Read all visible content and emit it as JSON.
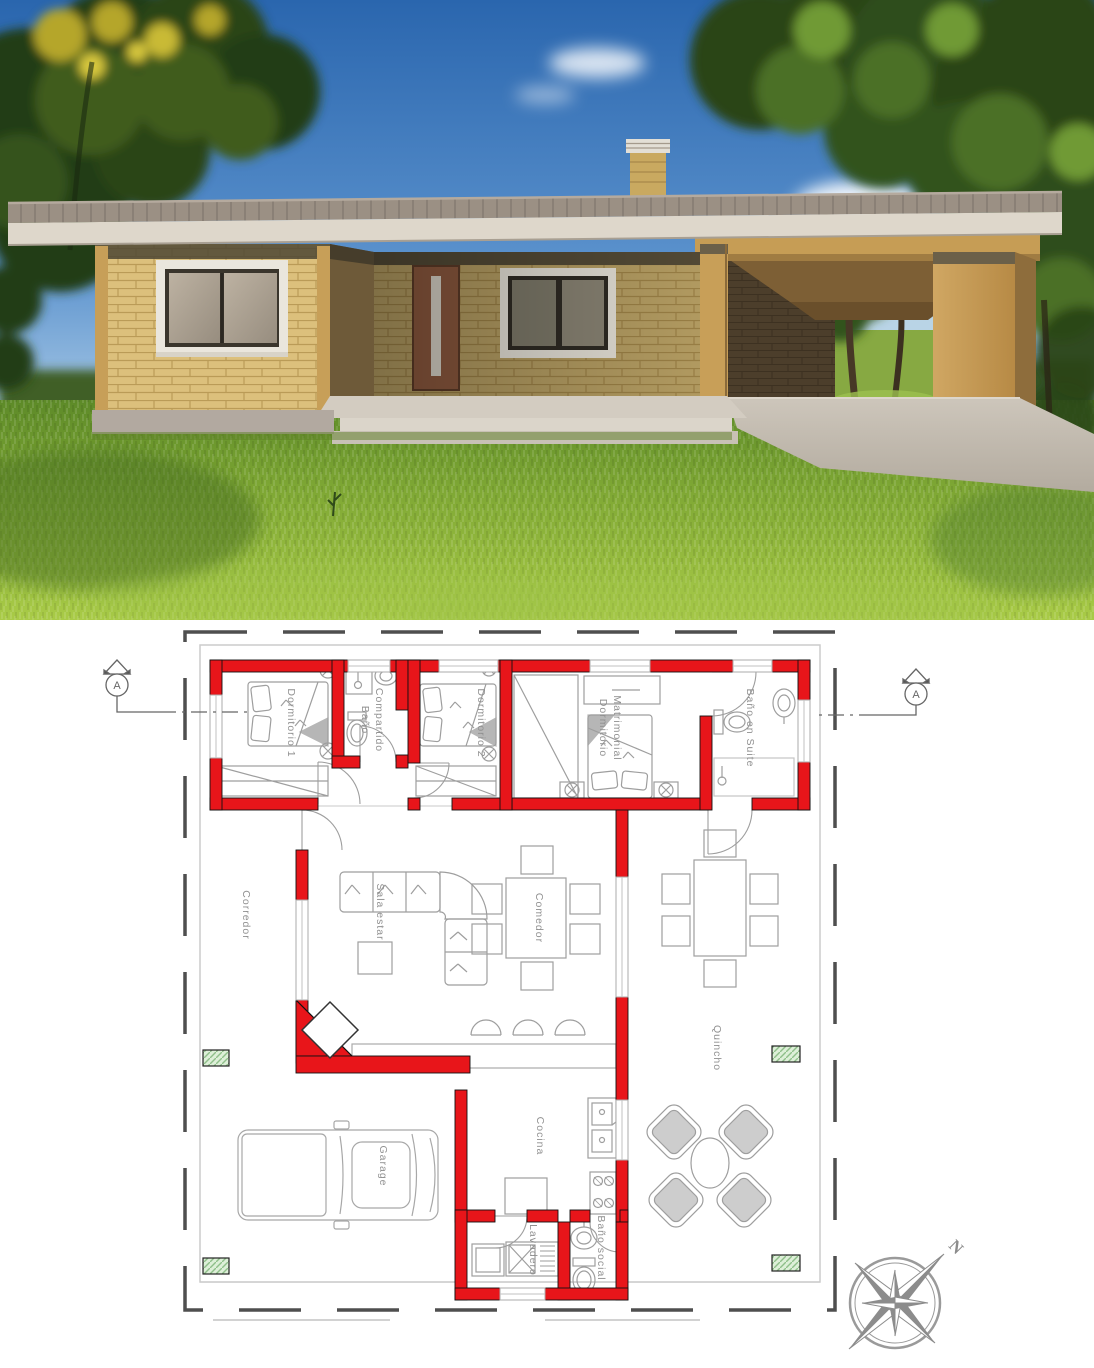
{
  "document": {
    "kind": "architectural-presentation",
    "top_panel": "exterior-3d-render",
    "bottom_panel": "floor-plan"
  },
  "render": {
    "colors": {
      "sky_blue": "#2a66ae",
      "grass_green": "#7ea734",
      "brick_tan": "#d9bd7a",
      "roof_fascia": "#ded7cb",
      "concrete": "#c9c2b7",
      "door_brown": "#8e5a3f"
    }
  },
  "floor_plan": {
    "colors": {
      "wall_red": "#e8151a",
      "furniture_gray": "#9e9e9e",
      "column_green": "#ddefd8",
      "label_gray": "#909090"
    },
    "section_markers": {
      "left": "A",
      "right": "A"
    },
    "compass": {
      "north_label": "N"
    },
    "rooms": [
      {
        "id": "dormitorio-1",
        "label": "Dormitorio 1"
      },
      {
        "id": "bano-compartido",
        "label": "Baño Compartido",
        "line1": "Baño",
        "line2": "Compartido"
      },
      {
        "id": "dormitorio-2",
        "label": "Dormitorio 2"
      },
      {
        "id": "dormitorio-matrimonial",
        "label": "Dormitorio Matrimonial",
        "line1": "Dormitorio",
        "line2": "Matrimonial"
      },
      {
        "id": "bano-en-suite",
        "label": "Baño en Suite"
      },
      {
        "id": "corredor",
        "label": "Corredor"
      },
      {
        "id": "sala-estar",
        "label": "Sala estar"
      },
      {
        "id": "comedor",
        "label": "Comedor"
      },
      {
        "id": "quincho",
        "label": "Quincho"
      },
      {
        "id": "cocina",
        "label": "Cocina"
      },
      {
        "id": "garage",
        "label": "Garage"
      },
      {
        "id": "lavadero",
        "label": "Lavadero"
      },
      {
        "id": "bano-social",
        "label": "Baño social"
      }
    ]
  }
}
